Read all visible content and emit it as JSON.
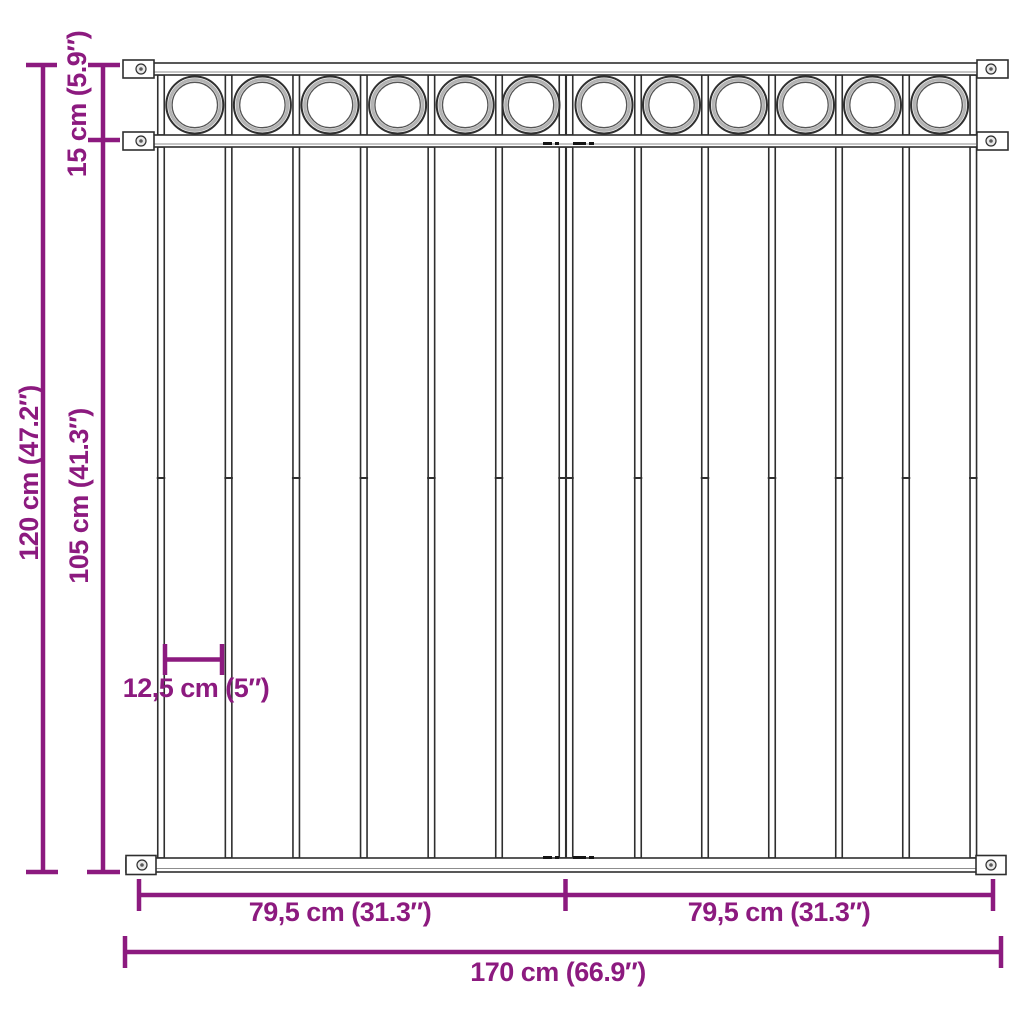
{
  "diagram": {
    "subject": "steel fence panel with circle ornaments – dimension drawing",
    "labels": {
      "top_section_height": "15 cm (5.9″)",
      "total_height": "120 cm (47.2″)",
      "bars_height": "105 cm (41.3″)",
      "bar_spacing": "12,5 cm (5″)",
      "left_half_width": "79,5 cm (31.3″)",
      "right_half_width": "79,5 cm (31.3″)",
      "total_width": "170 cm (66.9″)"
    },
    "colors": {
      "dimension": "#8c1a7f",
      "steel_outline": "#2f2f2f",
      "background": "#ffffff"
    },
    "figure": {
      "posts_x": [
        161,
        228.6,
        296.2,
        363.8,
        431.4,
        499,
        562.5,
        569.5,
        638,
        705,
        772,
        839,
        906,
        973.3
      ],
      "circles_x": [
        194.8,
        262.4,
        330,
        397.6,
        465.2,
        531,
        604,
        671.5,
        738.5,
        805.5,
        872.5,
        939.6
      ],
      "circle_cy": 105,
      "circle_r": 28.5,
      "post_top": 75,
      "post_bottom": 135,
      "bar_top": 147,
      "bar_bottom": 858,
      "bar_seam_y": 478,
      "bar_w": 6.5,
      "joint_dash_rows": [
        143.5,
        857.5
      ],
      "joint_dashes": [
        [
          543,
          9
        ],
        [
          555,
          4
        ],
        [
          573,
          13
        ],
        [
          589,
          5
        ]
      ]
    }
  }
}
